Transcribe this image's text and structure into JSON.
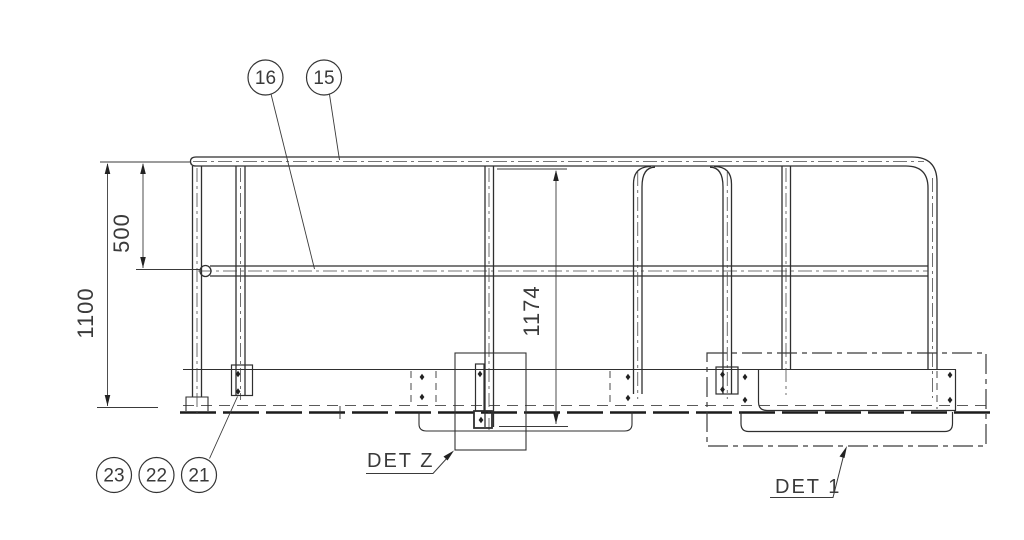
{
  "colors": {
    "background": "#ffffff",
    "line": "#2f2f2f",
    "hidden_line": "#5a5a5a",
    "heavy_line": "#1c1c1c",
    "text": "#3a3a3a"
  },
  "balloons": {
    "b16": "16",
    "b15": "15",
    "b23": "23",
    "b22": "22",
    "b21": "21"
  },
  "dimensions": {
    "overall_height": "1100",
    "top_to_mid_rail": "500",
    "post_total": "1174"
  },
  "details": {
    "det_z": "DET Z",
    "det_1": "DET 1"
  }
}
